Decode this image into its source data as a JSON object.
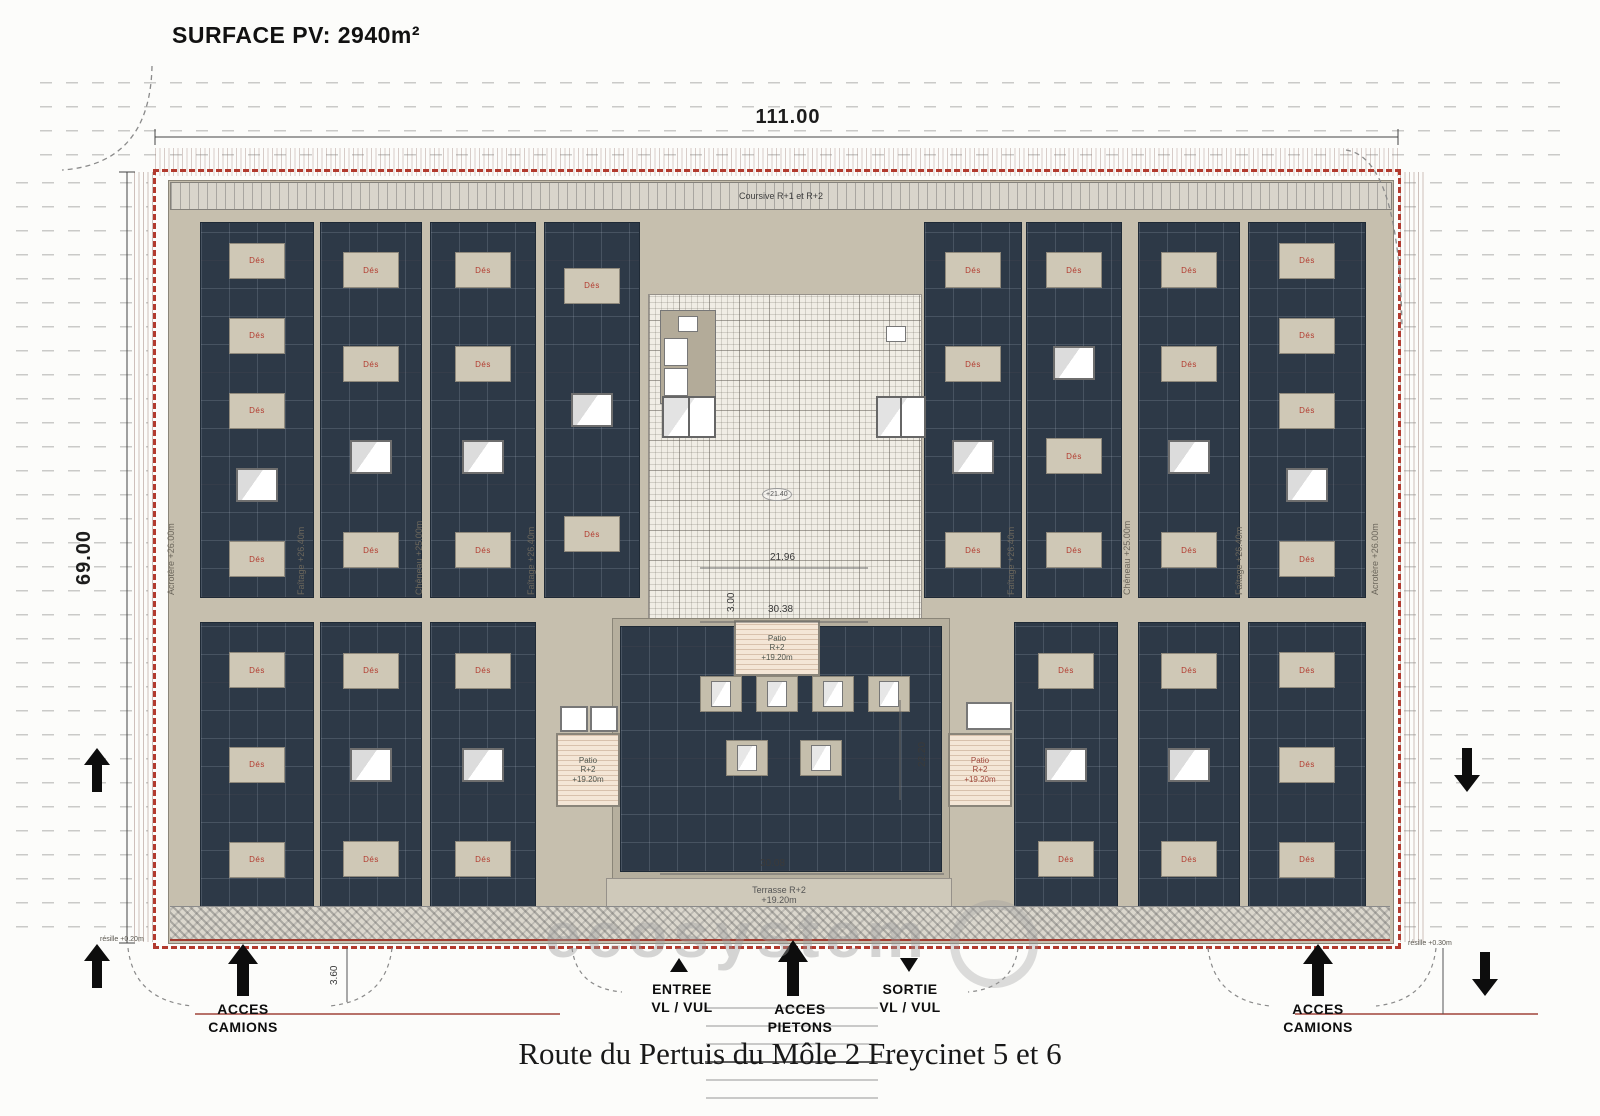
{
  "surface_label": "SURFACE PV: 2940m²",
  "street_title": "Route du Pertuis du Môle 2 Freycinet 5 et 6",
  "watermark": "ecosystem",
  "dimensions": {
    "total_width": "111.00",
    "total_height": "69.00",
    "courtyard_width": "21.96",
    "courtyard_offset": "3.00",
    "patio_block_width": "30.38",
    "terrasse_width": "30.08",
    "center_block_height": "22.20",
    "access_lane": "3.60",
    "level_marker": "+21.40"
  },
  "roof": {
    "coursive": "Coursive R+1 et R+2",
    "acrotere": "Acrotère +26.00m",
    "faitage": "Faîtage +26.40m",
    "cheneau": "Chêneau +25.00m",
    "vent_label": "Dés",
    "resille_left": "résille +0.20m",
    "resille_right": "résille +0.30m"
  },
  "patio": {
    "l1": "Patio",
    "l2": "R+2",
    "l3": "+19.20m"
  },
  "terrasse": {
    "l1": "Terrasse R+2",
    "l2": "+19.20m"
  },
  "access": {
    "camions_l1": "ACCES",
    "camions_l2": "CAMIONS",
    "entree_l1": "ENTREE",
    "entree_l2": "VL / VUL",
    "pietons_l1": "ACCES",
    "pietons_l2": "PIETONS",
    "sortie_l1": "SORTIE",
    "sortie_l2": "VL / VUL"
  },
  "colors": {
    "panel": "#2d3947",
    "roof": "#c6bfae",
    "boundary_red": "#b23a2e",
    "courtyard": "#f0ede5",
    "vent_text_red": "#b23a2e"
  }
}
